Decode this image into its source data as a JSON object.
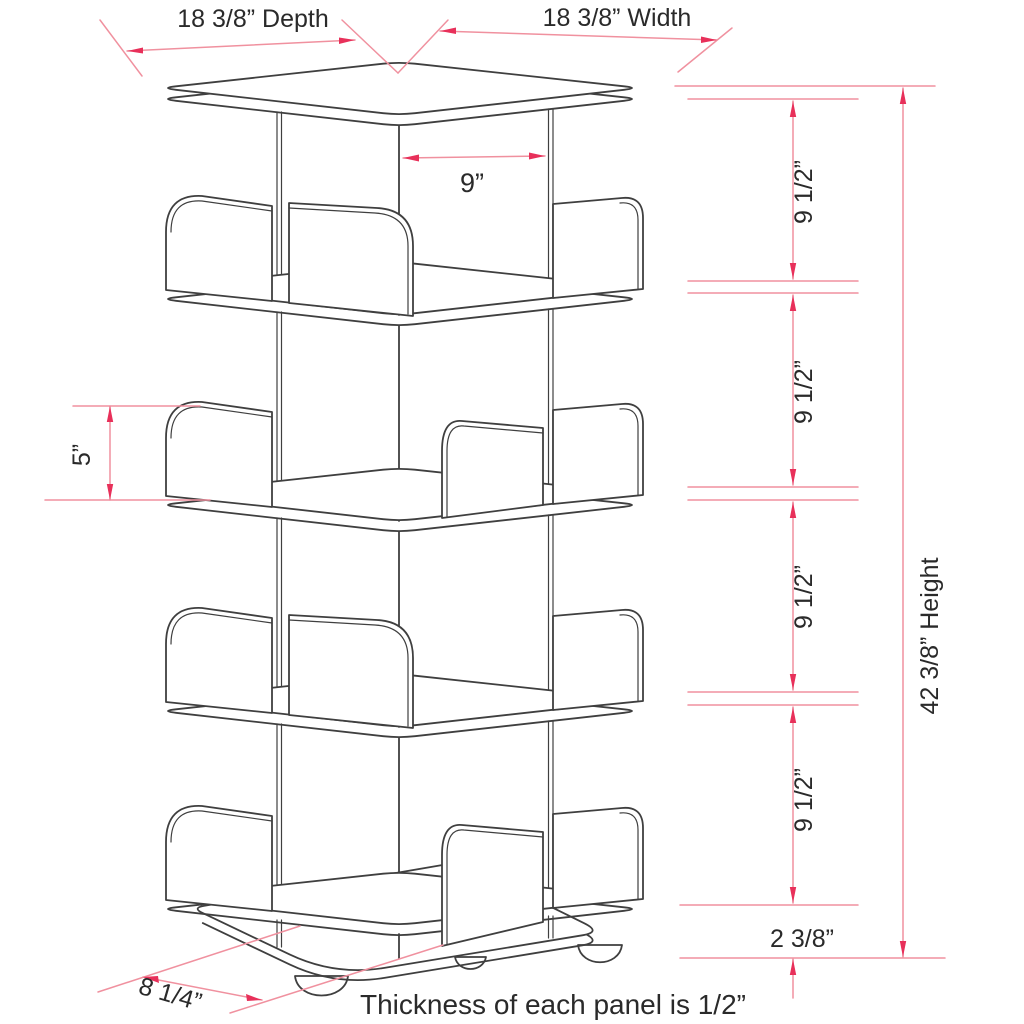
{
  "diagram": {
    "title": "Rotating bookcase dimension drawing",
    "labels": {
      "depth": "18 3/8” Depth",
      "width": "18 3/8” Width",
      "compartment_width": "9”",
      "shelf_spacing": "9 1/2”",
      "height": "42 3/8” Height",
      "divider_height": "5”",
      "base_clearance": "2 3/8”",
      "base_offset": "8 1/4”",
      "note": "Thickness of each panel is 1/2”"
    },
    "colors": {
      "line": "#3f3f3f",
      "dim_line": "#f0919f",
      "dim_arrow": "#e8305a",
      "text": "#2a2a2a"
    }
  }
}
